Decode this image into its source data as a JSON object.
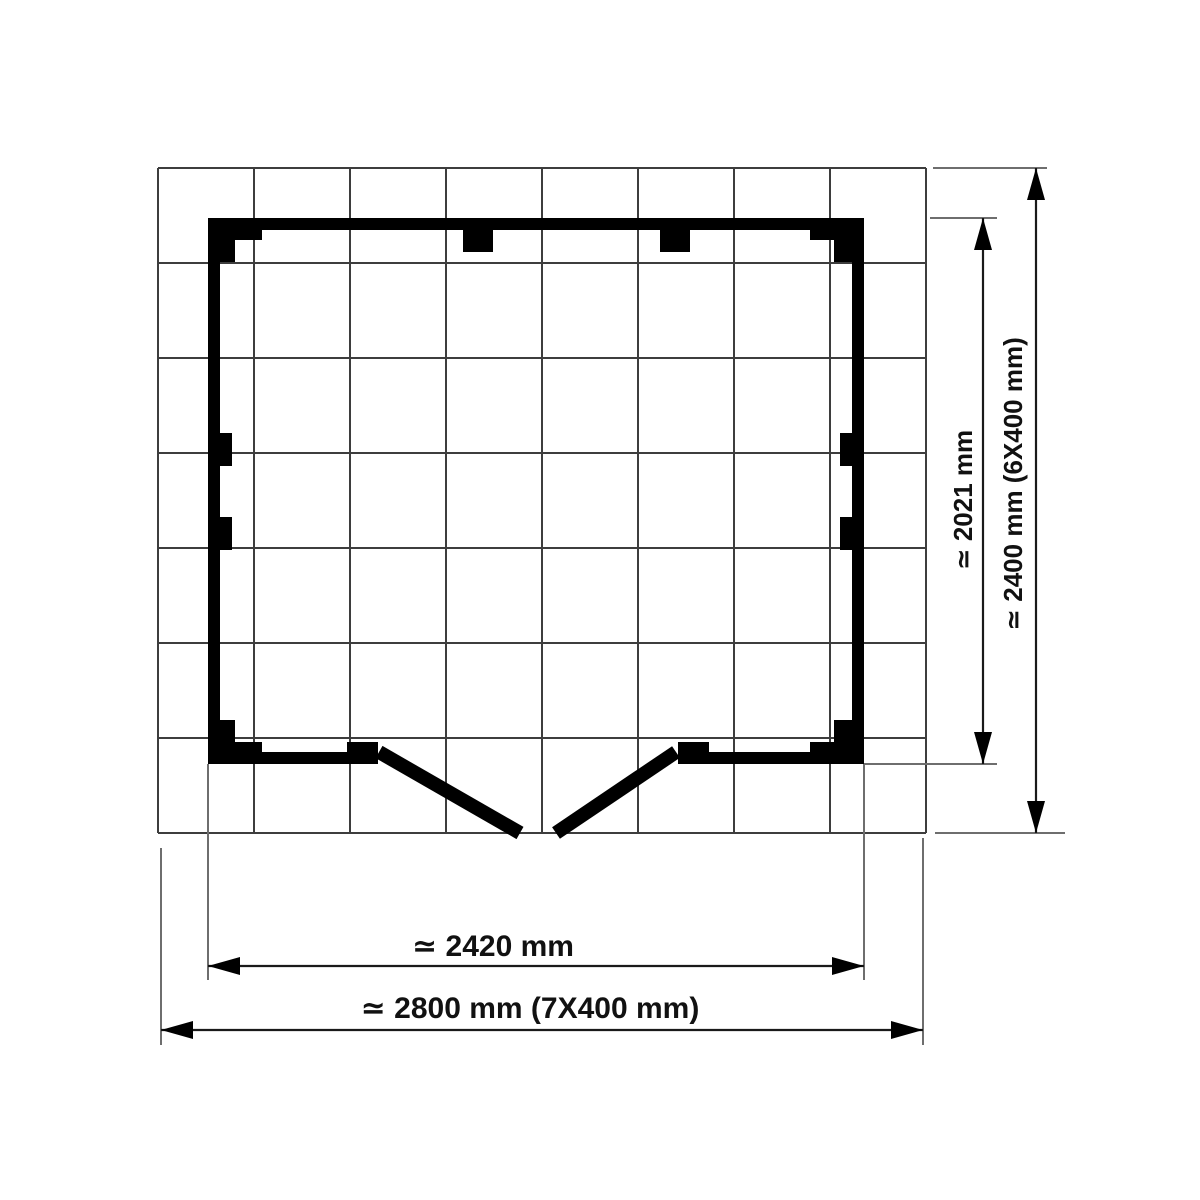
{
  "drawing": {
    "type": "shed-base-floor-plan",
    "unit": "mm",
    "grid": {
      "columns": 8,
      "rows": 7,
      "module_label": "400 mm"
    },
    "dimensions": {
      "inner_width": {
        "label": "≃ 2420 mm",
        "value": 2420
      },
      "outer_width": {
        "label": "≃ 2800 mm (7X400 mm)",
        "value": 2800
      },
      "inner_depth": {
        "label": "≃ 2021 mm",
        "value": 2021
      },
      "outer_depth": {
        "label": "≃ 2400 mm (6X400 mm)",
        "value": 2400
      }
    }
  }
}
